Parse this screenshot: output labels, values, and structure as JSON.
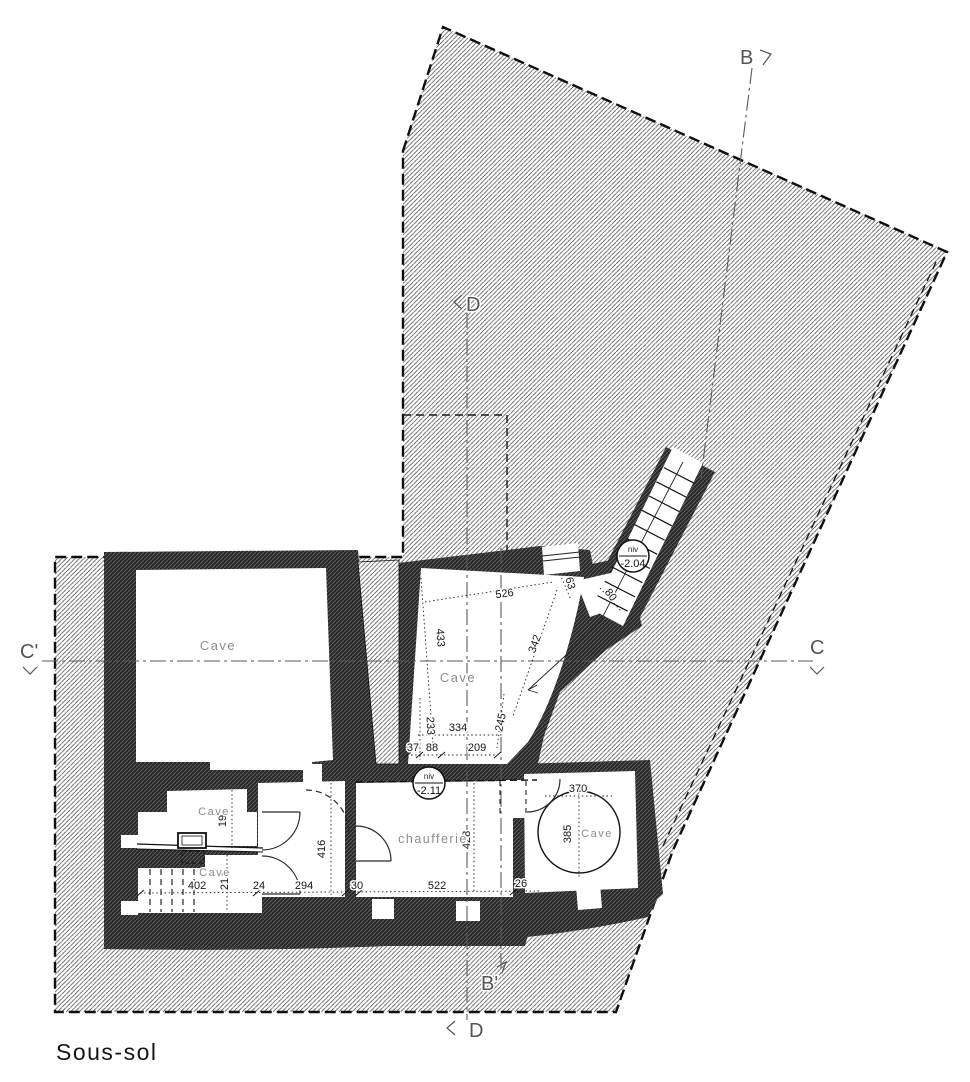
{
  "title": "Sous-sol",
  "plan": {
    "rooms": {
      "large_cave": "Cave",
      "central_cave": "Cave",
      "upper_small_cave": "Cave",
      "lower_small_cave": "Cave",
      "round_cave": "Cave",
      "boiler_room": "chaufferie"
    },
    "levels": {
      "stair": {
        "label": "niv",
        "value": "-2.04"
      },
      "boiler": {
        "label": "niv",
        "value": "-2.11"
      }
    },
    "sections": {
      "b_top": "B",
      "b_bottom": "B'",
      "c_right": "C",
      "c_left": "C'",
      "d_top": "D",
      "d_bottom": "D"
    },
    "dims": {
      "d526": "526",
      "d433": "433",
      "d342": "342",
      "d63": "63",
      "d80": "80",
      "d233": "233",
      "d334": "334",
      "d245": "245",
      "d37": "37",
      "d88": "88",
      "d209": "209",
      "d416": "416",
      "d294": "294",
      "d522": "522",
      "d428": "428",
      "d370": "370",
      "d385": "385",
      "d402": "402",
      "d214": "214",
      "d192": "192",
      "d24": "24",
      "d30": "30",
      "d26": "26"
    }
  }
}
